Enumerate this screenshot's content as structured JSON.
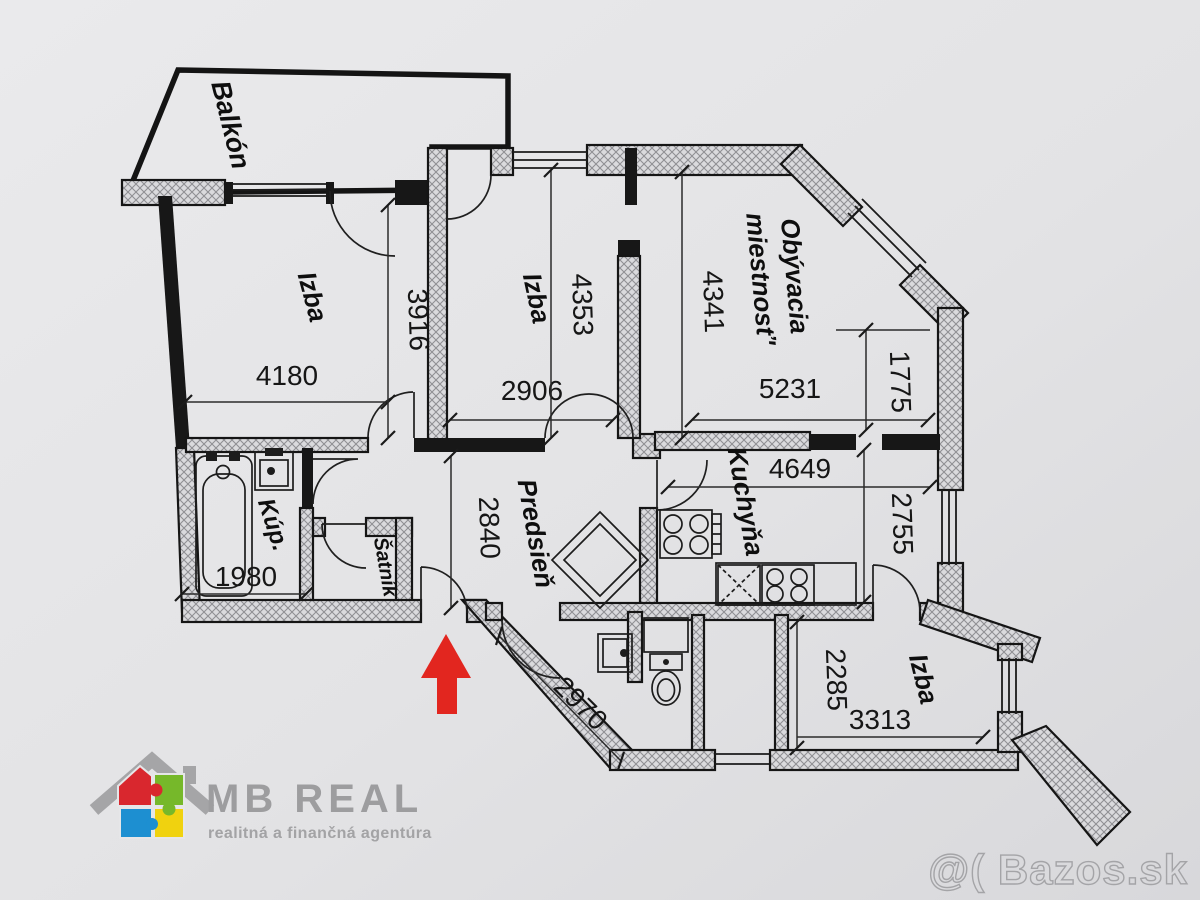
{
  "image": {
    "kind": "apartment floor plan (scanned photo)"
  },
  "rooms": {
    "balkon": {
      "label": "Balkón"
    },
    "izba1": {
      "label": "Izba"
    },
    "izba2": {
      "label": "Izba"
    },
    "obyvacia": {
      "line1": "Obývacia",
      "line2": "miestnosť'"
    },
    "kuchyna": {
      "label": "Kuchyňa"
    },
    "predsien": {
      "label": "Predsieň"
    },
    "kupelna": {
      "label": "Kúp."
    },
    "satnik": {
      "label": "Šatník"
    },
    "izba3": {
      "label": "Izba"
    }
  },
  "dims": {
    "izba1_w": "4180",
    "izba1_h": "3916",
    "izba2_w": "2906",
    "izba2_h": "4353",
    "obyv_w": "5231",
    "obyv_h": "4341",
    "obyv_corner": "1775",
    "kuch_w": "4649",
    "kuch_h": "2755",
    "predsien_h": "2840",
    "entry_diag": "2970",
    "kup_w": "1980",
    "izba3_h": "2285",
    "izba3_w": "3313"
  },
  "branding": {
    "name": "MB REAL",
    "tagline": "realitná a finančná agentúra"
  },
  "watermark": "@( Bazos.sk",
  "colors": {
    "arrow_red": "#e2261f",
    "logo_red": "#d9272e",
    "logo_green": "#76b82a",
    "logo_blue": "#1d8fd1",
    "logo_yellow": "#f0d20f",
    "logo_gray": "#9d9d9f",
    "logo_tag_gray": "#a3a3a5"
  }
}
